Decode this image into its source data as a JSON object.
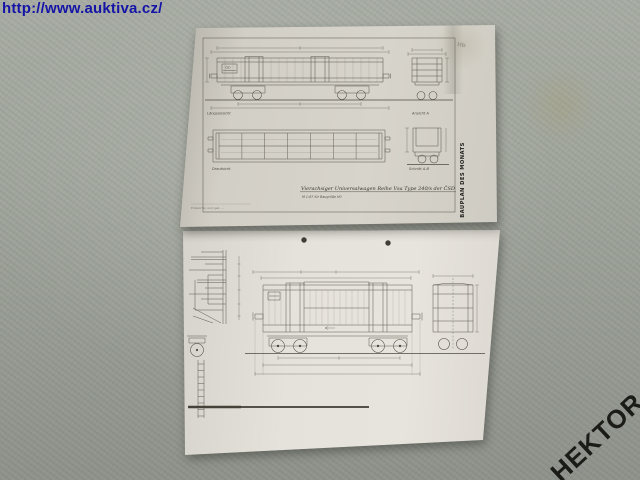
{
  "colors": {
    "background_gray": "#a2a79e",
    "top_paper": "#d4d1c8",
    "bottom_paper": "#e5e2db",
    "url_blue": "#1414a6",
    "watermark_black": "#1b1b17"
  },
  "watermarks": {
    "url": "http://www.auktiva.cz/",
    "seller": "HEKTOR"
  },
  "top_sheet": {
    "banner": "BAUPLAN DES MONATS",
    "pencil_note": "Hb",
    "wagon_marking": "ČSD",
    "title": "Vierachsiger Universalwagen Reihe Vsa Type 240/s der ČSD",
    "scale_note": "M 1:87 für Baugröße H0",
    "credit_note": "Entworfen und gez. ...",
    "view_labels": {
      "side": "Längsansicht",
      "end": "Ansicht A",
      "plan": "Draufsicht",
      "section": "Schnitt A-B"
    }
  }
}
